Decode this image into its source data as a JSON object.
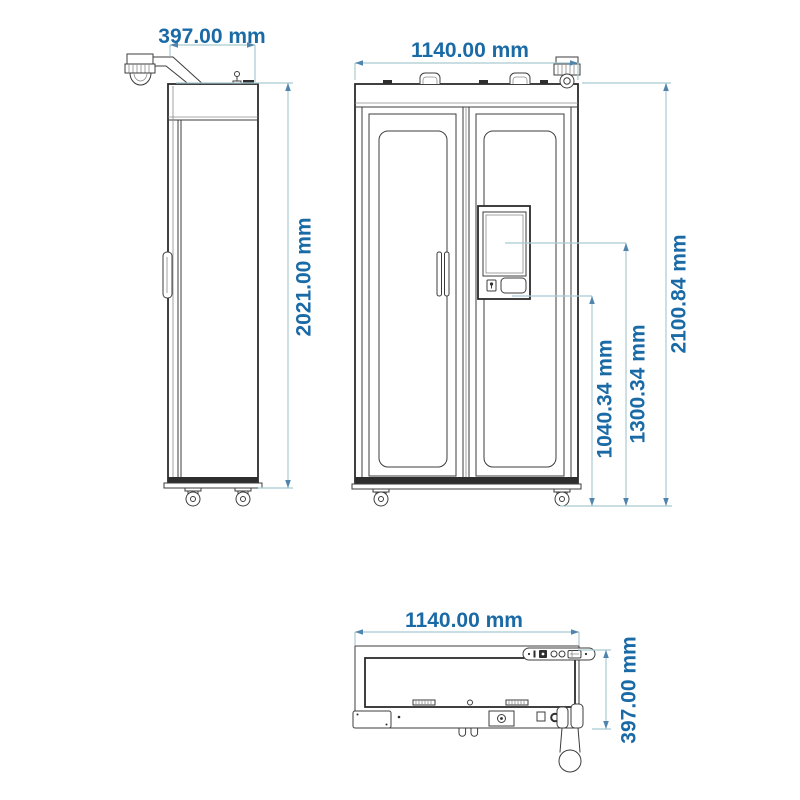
{
  "drawing": {
    "type": "technical-three-view-drawing",
    "subject": "double-door smart cabinet with surveillance camera and touchscreen kiosk",
    "units": "mm",
    "colors": {
      "background": "#ffffff",
      "drawing_line": "#3c3c3c",
      "dimension_line": "#a9cad2",
      "dimension_arrow": "#4f85ad",
      "dimension_text": "#1a6aa6"
    },
    "labels": {
      "side_depth": "397.00 mm",
      "side_height": "2021.00 mm",
      "front_width": "1140.00 mm",
      "front_screen_bottom_height": "1040.34 mm",
      "front_screen_center_height": "1300.34 mm",
      "front_total_height": "2100.84 mm",
      "top_width": "1140.00 mm",
      "top_depth": "397.00 mm"
    },
    "certification_strip_icons": [
      "dot",
      "info-bar",
      "filled-badge",
      "circle",
      "circle",
      "tray-badge",
      "dot"
    ]
  }
}
